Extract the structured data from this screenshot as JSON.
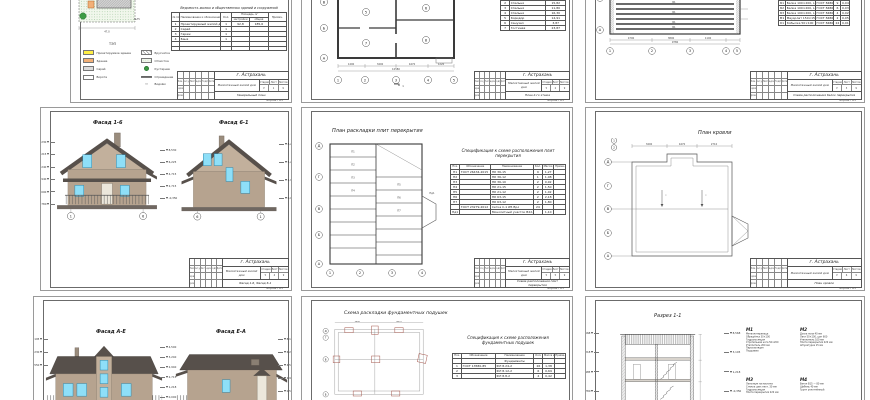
{
  "common": {
    "city": "г. Астрахань",
    "object": "Малоэтажный жилой дом",
    "format": "Формат А3",
    "stage_label": "Стадия",
    "list_label": "Лист",
    "lists_label": "Листов",
    "stage_val": "У",
    "lists_total": "9",
    "stamp_cols": [
      "Изм.",
      "Кол.уч",
      "Лист",
      "№док.",
      "Подп.",
      "Дата"
    ],
    "role1": "Разраб.",
    "role2": "Пров.",
    "spec_head": {
      "pos": "Поз.",
      "des": "Обозначение",
      "name": "Наименование",
      "qty": "Кол.",
      "mass": "Масса ед., т",
      "note": "Приме- чание"
    }
  },
  "colors": {
    "roof": "#57504b",
    "wall": "#b6a38f",
    "gable": "#c2b09c",
    "window": "#8edff8",
    "window_frame": "#2f89ad",
    "ground": "#6f6761",
    "door": "#ece7db",
    "site_green": "#f1f7ec",
    "tree_green": "#3d9b44",
    "accent_yellow": "#ffee44",
    "accent_orange": "#f2b077",
    "red_line": "#a5584e"
  },
  "sheet1": {
    "site_label": "№75",
    "site_dim": "47,0",
    "tep": "ТЭП",
    "legend_left": [
      "Проектируемое здание",
      "Здание",
      "Сарай",
      "Ворота"
    ],
    "legend_right": [
      "Брусчатка",
      "Отмостка",
      "Кустарник",
      "Ограждение",
      "Водоём"
    ],
    "table_title": "Ведомость жилых и общественных зданий и сооружений",
    "h": {
      "num": "№ поз.",
      "name": "Наименование и обозначение",
      "qty": "Кол.",
      "area": "Площадь, м²",
      "a1": "застройки",
      "a2": "общая",
      "note": "Примеч."
    },
    "rows": [
      [
        "1",
        "Проектируемый жилой дом",
        "1",
        "92,8",
        "185,6"
      ],
      [
        "2",
        "Сарай",
        "1",
        "",
        ""
      ],
      [
        "3",
        "Гараж",
        "1",
        "",
        ""
      ],
      [
        "4",
        "Баня",
        "1",
        "",
        ""
      ]
    ],
    "tb_doc": "Генеральный план",
    "sheet_no": "1"
  },
  "sheet2": {
    "rooms": [
      "5",
      "6",
      "7",
      "8"
    ],
    "expl_rows": [
      [
        "2",
        "Спальня",
        "15,82"
      ],
      [
        "3",
        "Спальня",
        "11,80"
      ],
      [
        "4",
        "Спальня",
        "16,30"
      ],
      [
        "5",
        "Коридор",
        "14,91"
      ],
      [
        "6",
        "Санузел",
        "3,87"
      ],
      [
        "7",
        "Гостиная",
        "23,87"
      ]
    ],
    "axes_bottom": [
      "1",
      "2",
      "3",
      "4",
      "5"
    ],
    "axes_left": [
      "В",
      "Б",
      "А"
    ],
    "dims": [
      "1490",
      "3400",
      "4470",
      "1220"
    ],
    "total_dim": "10580",
    "section_mark": "1",
    "tb_doc": "План 2-го этажа",
    "sheet_no": "2"
  },
  "sheet3": {
    "beam_labels": [
      "Б1",
      "Б1",
      "Б1",
      "Б1"
    ],
    "spec_rows": [
      [
        "Б1",
        "Балка 100×200, L=4790",
        "ГОСТ 8486-86",
        "9",
        "0,04"
      ],
      [
        "Б2",
        "Балка 100×200, L=3890",
        "ГОСТ 8486-86",
        "6",
        "0,03"
      ],
      [
        "Б3",
        "Балка 100×200, L=2990",
        "ГОСТ 8486-86",
        "4",
        "0,02"
      ],
      [
        "М1",
        "Мауэрлат 150×150",
        "ГОСТ 8486-86",
        "2",
        "0,05"
      ],
      [
        "К1",
        "Кобылка 50×100",
        "ГОСТ 8486-86",
        "24",
        "0,01"
      ]
    ],
    "axes_bottom": [
      "1",
      "2",
      "3",
      "4",
      "5"
    ],
    "axes_left": [
      "Д",
      "А"
    ],
    "dims": [
      "4790",
      "3890",
      "1100"
    ],
    "total_dim": "9780",
    "tb_doc": "Схема расположения балок перекрытия",
    "sheet_no": "3"
  },
  "sheet4": {
    "title_a": "Фасад 1-6",
    "title_b": "Фасад 6-1",
    "marks_a_left": [
      "8,230",
      "5,215",
      "3,240",
      "2,940",
      "0,000",
      "-0,780"
    ],
    "marks_a_right": [
      "8,530",
      "6,225",
      "4,715",
      "2,715",
      "-0,350"
    ],
    "marks_b_left": [
      "8,530",
      "6,225",
      "2,715",
      "-0,350"
    ],
    "marks_b_right": [
      "8,230",
      "5,215",
      "2,940",
      "0,000"
    ],
    "axes_a": [
      "1",
      "6"
    ],
    "axes_b": [
      "6",
      "1"
    ],
    "tb_doc": "Фасад 1-6, Фасад 6-1",
    "sheet_no": "4"
  },
  "sheet5": {
    "title": "План раскладки плит перекрытия",
    "spec_title_1": "Спецификация к схеме расположения плит",
    "spec_title_2": "перекрытия",
    "spec_rows": [
      [
        "П1",
        "ГОСТ 26434-2015",
        "ПК 36-15",
        "9",
        "1,27"
      ],
      [
        "П2",
        "",
        "ПК 36-12",
        "1",
        "1,08"
      ],
      [
        "П3",
        "",
        "ПК 36-10",
        "2",
        "0,92"
      ],
      [
        "П4",
        "",
        "ПК 21-15",
        "2",
        "1,50"
      ],
      [
        "П5",
        "",
        "ПК 21-12",
        "2",
        "1,02"
      ],
      [
        "П6",
        "",
        "ПК 63-15",
        "2",
        "2,18"
      ],
      [
        "П7",
        "",
        "ПК 63-12",
        "2",
        "1,80"
      ],
      [
        "",
        "ГОСТ 23279-2012",
        "Сетка С-1 Ø5 Вр-I",
        "24",
        ""
      ],
      [
        "Пд1",
        "",
        "Монолитный участок В22,5",
        "",
        "1,10"
      ]
    ],
    "slab_labels": [
      "П1",
      "П2",
      "П3",
      "П4",
      "П5",
      "П6",
      "П7"
    ],
    "bay_label": "Пд1",
    "axes_left": [
      "Д",
      "Г",
      "В",
      "Б",
      "А"
    ],
    "axes_bottom": [
      "1",
      "2",
      "3",
      "4"
    ],
    "tb_doc": "Схема расположения плит перекрытия",
    "sheet_no": "5"
  },
  "sheet6": {
    "title": "План кровли",
    "axes_left": [
      "Д",
      "Г",
      "В",
      "Б",
      "А"
    ],
    "axes_top": [
      "1",
      "2"
    ],
    "slope_1": "i",
    "slope_2": "i",
    "dims": [
      "3400",
      "4470",
      "2710"
    ],
    "tb_doc": "План кровли",
    "sheet_no": "6"
  },
  "sheet7": {
    "title_a": "Фасад А-Е",
    "title_b": "Фасад Е-А",
    "marks_a_left": [
      "8,195",
      "6,230",
      "4,550"
    ],
    "marks_mid": [
      "4,500",
      "3,240",
      "2,940",
      "2,715",
      "1,218",
      "0,000"
    ],
    "marks_b_right": [
      "8,195",
      "6,230",
      "4,550",
      "2,987",
      "0,500"
    ]
  },
  "sheet8": {
    "title": "Схема раскладки фундаментных подушек",
    "spec_title_1": "Спецификация к схеме расположения",
    "spec_title_2": "фундаментных подушек",
    "group": "Фундаменты",
    "spec_rows": [
      [
        "1",
        "ГОСТ 13580-85",
        "ФЛ 8.24-2",
        "26",
        "1,38"
      ],
      [
        "2",
        "",
        "ФЛ 8.12-2",
        "6",
        "0,69"
      ],
      [
        "3",
        "",
        "ФЛ 8.8-2",
        "4",
        "0,42"
      ]
    ],
    "axes_left": [
      "Д",
      "Г",
      "В",
      "Б"
    ],
    "dims": [
      "3400",
      "4470"
    ]
  },
  "sheet9": {
    "title": "Разрез 1-1",
    "marks_left": [
      "8,568",
      "5,218",
      "2,985",
      "-0,780"
    ],
    "marks_right": [
      "8,568",
      "3,105",
      "1,218",
      "-0,350"
    ],
    "nodes": [
      {
        "name": "М1",
        "lines": [
          "Металлочерепица",
          "Обрешётка 30×100",
          "Гидроизоляция",
          "Стропильная нога 50×200",
          "Утеплитель 200 мм",
          "Пароизоляция",
          "Подшивка"
        ]
      },
      {
        "name": "М2",
        "lines": [
          "Доска пола 40 мм",
          "Лаги 50×100, шаг 600",
          "Утеплитель 100 мм",
          "Плита перекрытия 220 мм",
          "Штукатурка 15 мм"
        ]
      },
      {
        "name": "М3",
        "lines": [
          "Линолеум на мастике",
          "Стяжка цем.-песч. 30 мм",
          "Гидроизоляция",
          "Плита перекрытия 220 мм"
        ]
      },
      {
        "name": "М4",
        "lines": [
          "Бетон В15 — 80 мм",
          "Щебень 40 мм",
          "Грунт уплотнённый"
        ]
      }
    ]
  }
}
